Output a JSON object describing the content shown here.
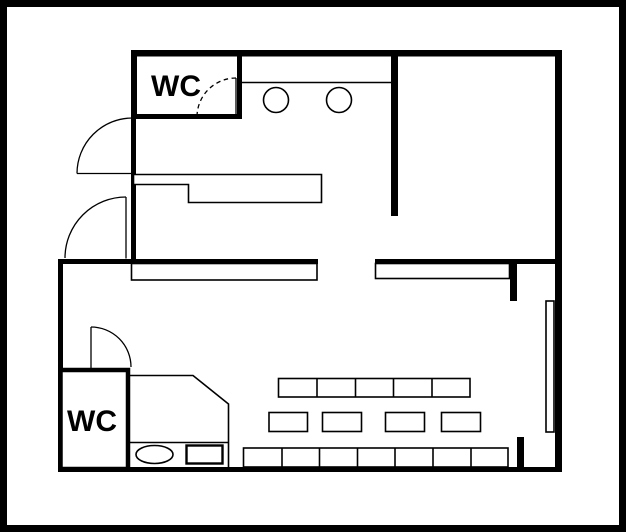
{
  "page": {
    "type": "floor-plan",
    "background_color": "#ffffff",
    "line_color": "#000000"
  },
  "rooms": [
    {
      "id": "wc-upper",
      "label": "WC"
    },
    {
      "id": "wc-lower",
      "label": "WC"
    }
  ],
  "fixtures": {
    "sink_circles_count": 2,
    "top_table_row_seats": 5,
    "middle_table_count": 4,
    "bottom_table_row_seats": 7
  }
}
